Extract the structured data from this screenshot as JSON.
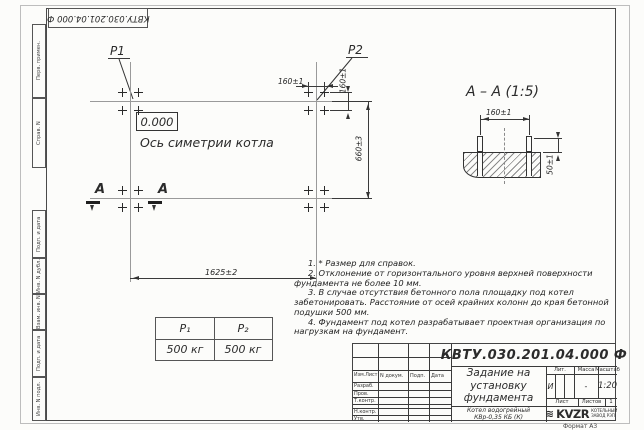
{
  "sheet": {
    "top_stamp": "КВТУ.030.201.04.000 Ф",
    "format_note": "Формат А3",
    "side_stamps": {
      "perv_primen": "Перв. примен.",
      "sprav_n": "Справ. N",
      "podp_data_1": "Подп. и дата",
      "inv_dubl": "Инв. N дубл.",
      "vzam_inv": "Взам. инв. N",
      "podp_data_2": "Подп. и дата",
      "inv_podl": "Инв. N подл."
    }
  },
  "plan": {
    "p1_label": "P1",
    "p2_label": "P2",
    "elevation_mark": "0.000",
    "axis_label": "Ось симетрии котла",
    "section_letter_1": "А",
    "section_letter_2": "А",
    "dim_bolt_h": "160±1",
    "dim_bolt_v": "160±1",
    "dim_rows": "660±3",
    "dim_groups": "1625±2"
  },
  "section_view": {
    "title": "А – А (1:5)",
    "dim_bolts": "160±1",
    "dim_height": "50±1"
  },
  "load_table": {
    "col1_header": "P₁",
    "col2_header": "P₂",
    "col1_value": "500 кг",
    "col2_value": "500 кг"
  },
  "notes": {
    "n1": "1. * Размер для справок.",
    "n2": "2. Отклонение от горизонтального уровня верхней поверхности фундамента не более 10 мм.",
    "n3": "3. В случае отсутствия бетонного пола площадку под котел забетонировать. Расстояние от осей крайних колонн до края бетонной подушки 500 мм.",
    "n4": "4. Фундамент под котел разрабатывает проектная организация по нагрузкам на фундамент."
  },
  "title_block": {
    "doc_number": "КВТУ.030.201.04.000 Ф",
    "doc_title": "Задание на установку фундамента",
    "product_line1": "Котел водогрейный",
    "product_line2": "КВр-0,35 КБ (К)",
    "col_izm": "Изм.Лист",
    "col_ndoc": "N докум.",
    "col_podp": "Подп.",
    "col_data": "Дата",
    "row_razrab": "Разраб.",
    "row_prov": "Пров.",
    "row_tkontr": "Т.контр.",
    "row_nkontr": "Н.контр.",
    "row_utv": "Утв.",
    "lit_header": "Лит.",
    "lit_value": "И",
    "mass_header": "Масса",
    "mass_value": "-",
    "scale_header": "Масштаб",
    "scale_value": "1:20",
    "sheet_header": "Лист",
    "sheets_header": "Листов",
    "sheets_value": "1",
    "logo_mark": "≋",
    "logo_text": "KVZR",
    "company_line1": "КОТЕЛЬНЫЙ",
    "company_line2": "ЗАВОД РЭП"
  }
}
